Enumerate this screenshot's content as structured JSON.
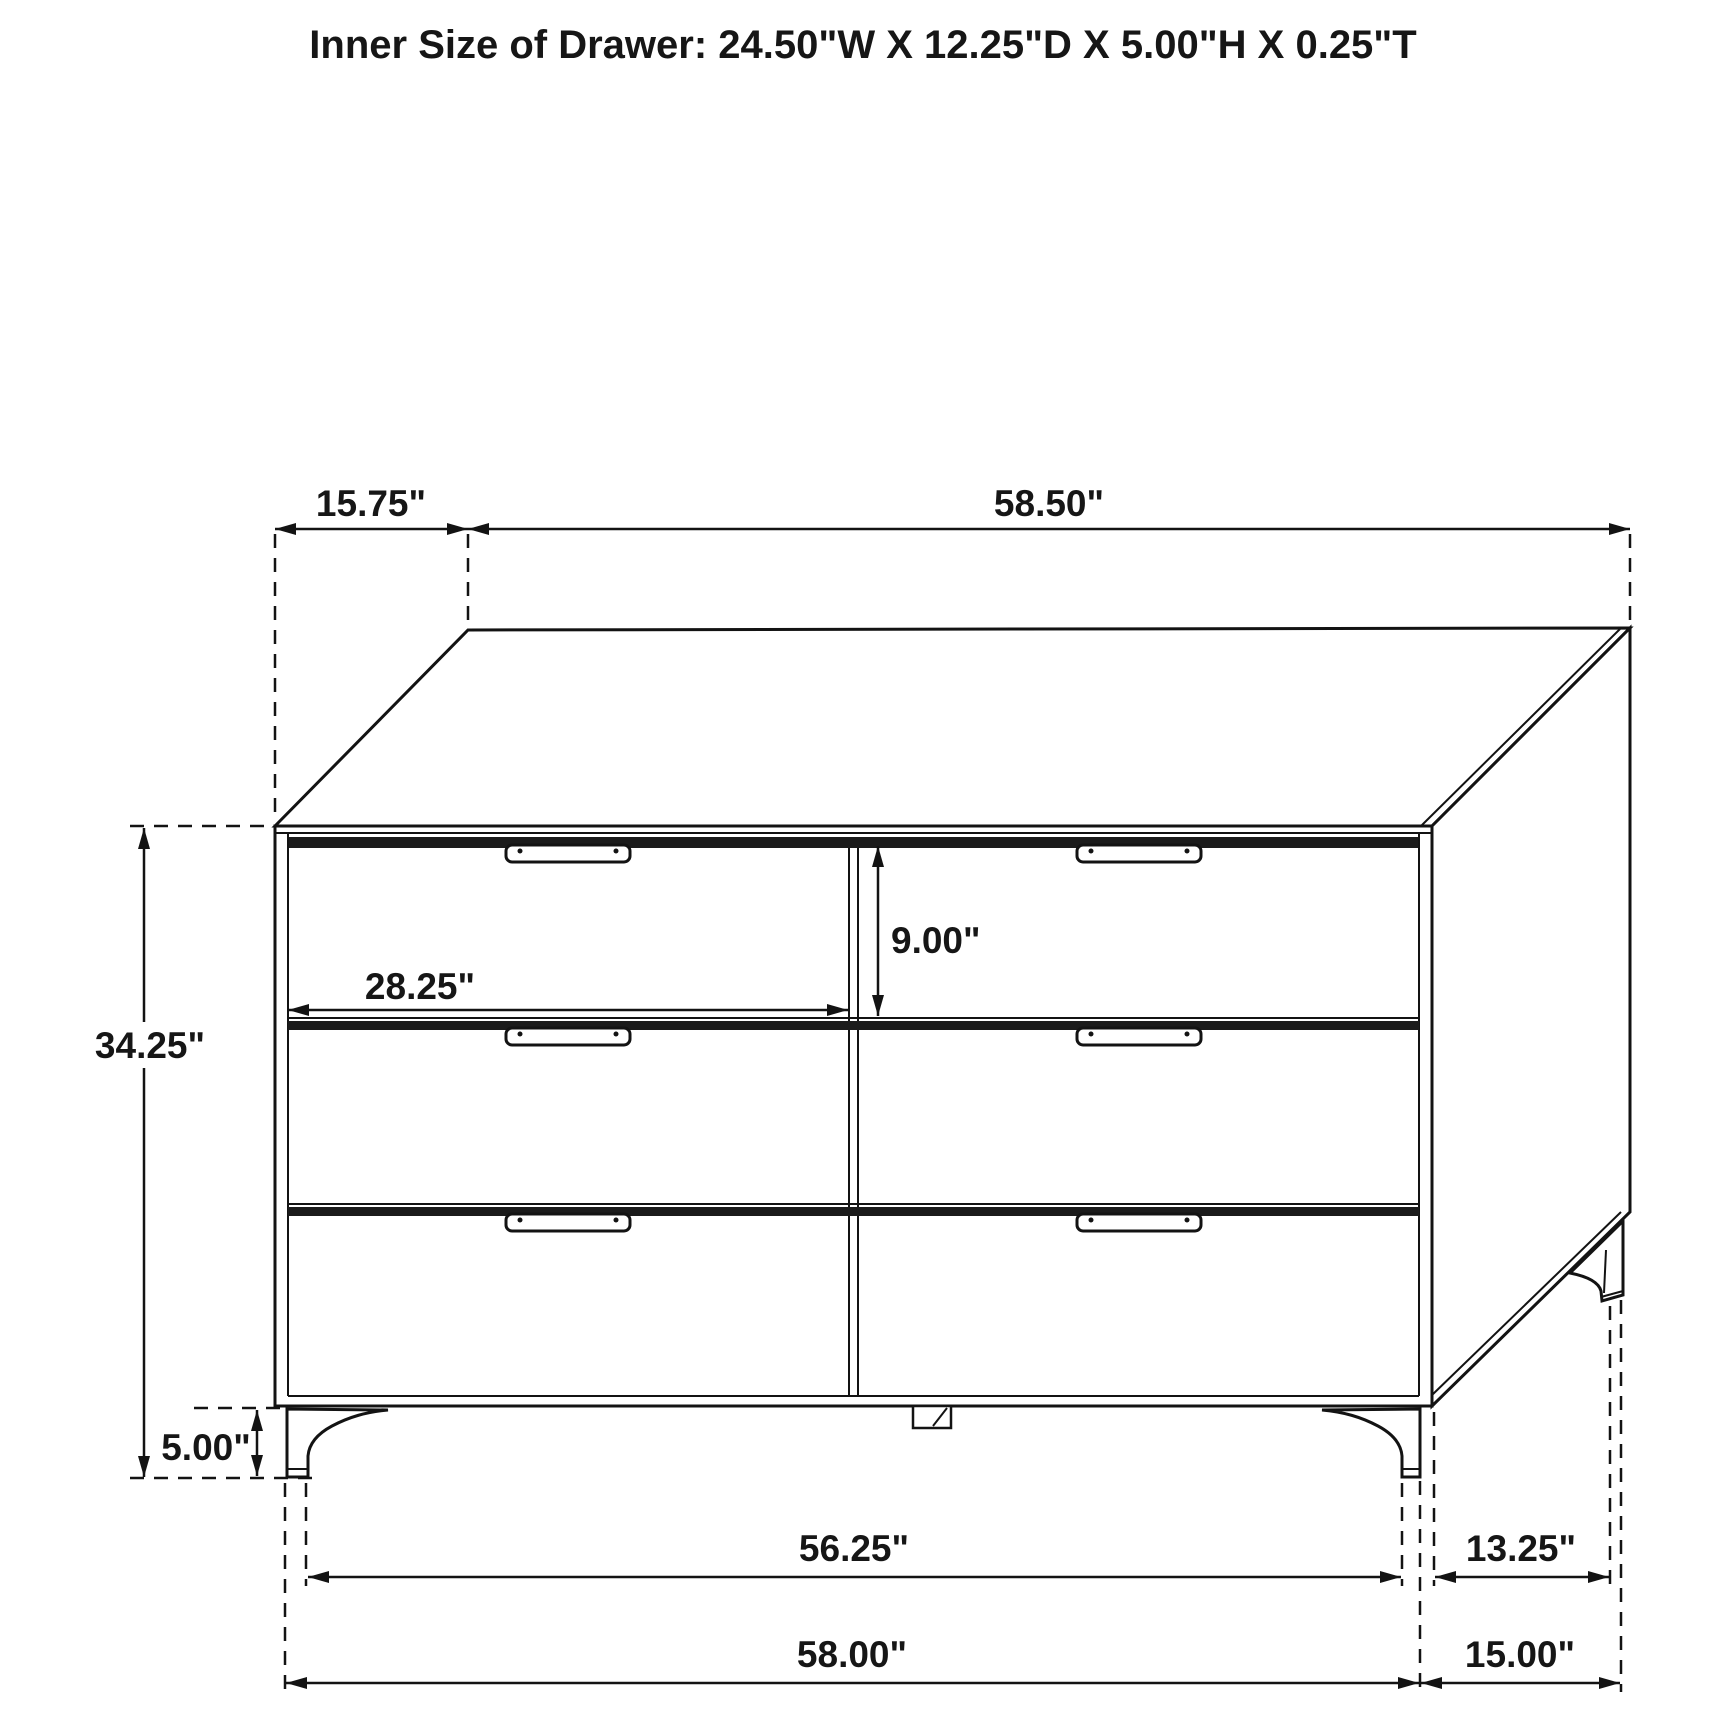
{
  "title": "Inner Size of Drawer: 24.50\"W X 12.25\"D X 5.00\"H X 0.25\"T",
  "diagram": {
    "object": "six-drawer-dresser",
    "view": "front perspective line drawing with dimension callouts",
    "drawer_grid": {
      "columns": 2,
      "rows": 3
    },
    "dimensions": {
      "top_depth": "15.75\"",
      "top_width": "58.50\"",
      "drawer_front_width": "28.25\"",
      "drawer_front_height": "9.00\"",
      "case_height": "34.25\"",
      "leg_height": "5.00\"",
      "front_feet_span": "56.25\"",
      "side_feet_span": "13.25\"",
      "overall_width": "58.00\"",
      "overall_depth": "15.00\""
    },
    "line_color": "#131313",
    "background_color": "#ffffff"
  }
}
